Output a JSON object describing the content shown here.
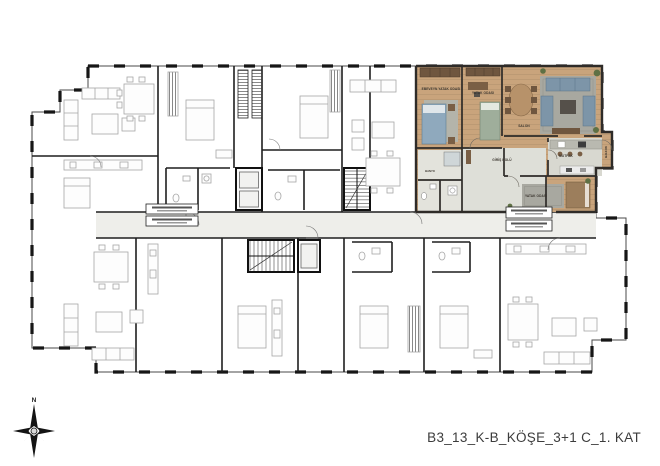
{
  "caption": "B3_13_K-B_KÖŞE_3+1 C_1. KAT",
  "compass": {
    "north_label": "N"
  },
  "unit": {
    "name": "highlighted-apartment-3plus1",
    "rooms": {
      "master_bedroom": "EBEVEYN YATAK ODASI",
      "bedroom2": "YATAK ODASI",
      "salon": "SALON",
      "entry_hall": "GİRİŞ HOLÜ",
      "kitchen": "MUTFAK",
      "bathroom": "BANYO",
      "bedroom3": "YATAK ODASI",
      "balcony": "BALKON"
    },
    "colors": {
      "floor_wood": "#c9a47c",
      "tile": "#dedfd8",
      "rug": "#a8a8a0",
      "sofa": "#7d95a8",
      "bed": "#8fa9bd",
      "wood_dark": "#6f563f",
      "plant": "#5e7044",
      "wall": "#2e2b28"
    }
  },
  "plan": {
    "line_color": "#1f1f1f",
    "furniture_color": "#a6a6a6",
    "corridor_fill": "#eeeeea"
  }
}
